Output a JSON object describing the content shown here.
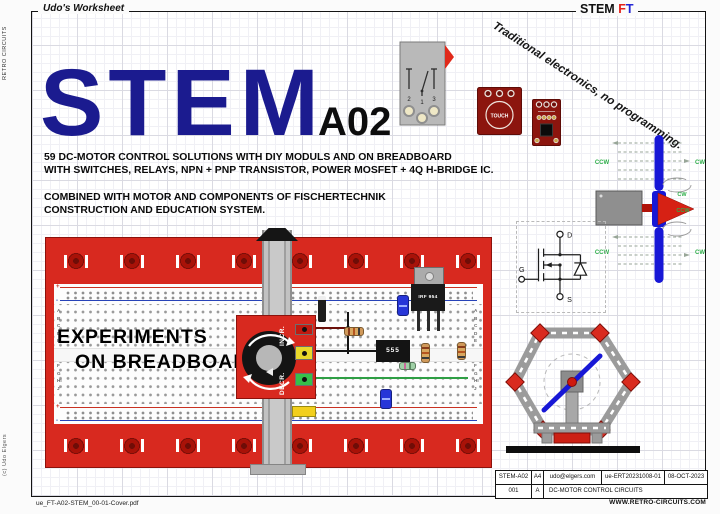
{
  "header": {
    "worksheet_label": "Udo's Worksheet",
    "brand_stem": "STEM",
    "brand_f": "F",
    "brand_t": "T"
  },
  "margins": {
    "side_top": "RETRO CIRCUITS",
    "side_bottom": "(c) Udo Elgers",
    "footer_file": "ue_FT-A02-STEM_00-01-Cover.pdf"
  },
  "title": {
    "main": "STEM",
    "code": "A02"
  },
  "intro": {
    "l1": "59 DC-MOTOR CONTROL SOLUTIONS WITH DIY MODULS AND ON BREADBOARD",
    "l2": "WITH SWITCHES, RELAYS, NPN + PNP TRANSISTOR, POWER MOSFET + 4Q H-BRIDGE IC.",
    "l3": "COMBINED WITH MOTOR AND COMPONENTS OF FISCHERTECHNIK",
    "l4": "CONSTRUCTION AND EDUCATION SYSTEM."
  },
  "tagline": "Traditional electronics, no programming.",
  "modules": {
    "switch_pins": [
      "2",
      "1",
      "3"
    ],
    "touch_label": "TOUCH"
  },
  "mosfet": {
    "drain": "D",
    "gate": "G",
    "source": "S"
  },
  "fan": {
    "ccw": "CCW",
    "cw": "CW"
  },
  "breadboard": {
    "overlay_line1": "EXPERIMENTS",
    "overlay_line2": "ON BREADBOARD",
    "pot_up": "INCR.",
    "pot_down": "DECR.",
    "transistor": "IRF 954",
    "timer_ic": "555",
    "rows_top": "ABCDE",
    "rows_bottom": "FGHIJ",
    "plus": "+",
    "minus": "-"
  },
  "titleblock": {
    "doc_id": "STEM-A02",
    "paper": "A4",
    "email": "udo@elgers.com",
    "ref": "ue-ERT20231008-01",
    "date": "08-OCT-2023",
    "sheet": "001",
    "rev": "A",
    "doc_title": "DC-MOTOR CONTROL CIRCUITS",
    "website": "WWW.RETRO-CIRCUITS.COM"
  },
  "colors": {
    "brand_navy": "#1b1b8f",
    "ft_f_red": "#e3211a",
    "ft_t_blue": "#2427d6",
    "board_red": "#d8291f",
    "propeller_blue": "#1717d6",
    "label_green": "#2faf4a"
  }
}
